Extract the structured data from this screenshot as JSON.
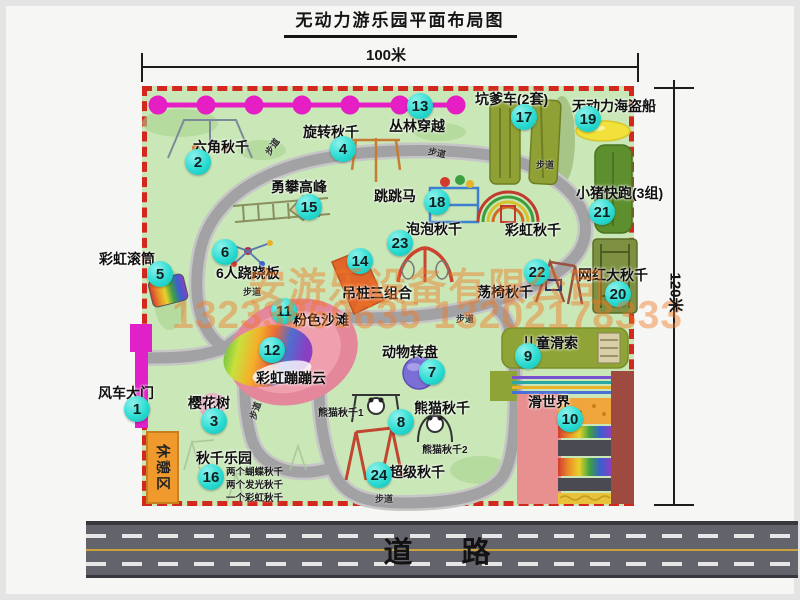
{
  "title": "无动力游乐园平面布局图",
  "dim_width": "100米",
  "dim_height": "120米",
  "road_label": "道　路",
  "path_label": "步道",
  "rest_area_label": "休憩区",
  "rainbow_swing_label": "彩虹秋千",
  "watermark": {
    "company": "安游乐设备有限公司",
    "phone": "13233860635 13202178333"
  },
  "notes": {
    "panda_1": "熊猫秋千1",
    "panda_2": "熊猫秋千2",
    "swing_park": [
      "两个蝴蝶秋千",
      "两个发光秋千",
      "一个彩虹秋千"
    ]
  },
  "colors": {
    "park_green": "#c9e7b7",
    "border_red": "#d3281e",
    "number_badge": "#2bdcd2",
    "zipline_magenta": "#e51fc4",
    "road_gray": "#63636b",
    "watermark_orange": "#f07823",
    "rest_area_orange": "#f09a2e"
  },
  "attractions": [
    {
      "num": "1",
      "name": "风车大门"
    },
    {
      "num": "2",
      "name": "六角秋千"
    },
    {
      "num": "3",
      "name": "樱花树"
    },
    {
      "num": "4",
      "name": "旋转秋千"
    },
    {
      "num": "5",
      "name": "彩虹滚筒"
    },
    {
      "num": "6",
      "name": "6人跷跷板"
    },
    {
      "num": "7",
      "name": "动物转盘"
    },
    {
      "num": "8",
      "name": "熊猫秋千"
    },
    {
      "num": "9",
      "name": "儿童滑索"
    },
    {
      "num": "10",
      "name": "滑世界"
    },
    {
      "num": "11",
      "name": "粉色沙滩"
    },
    {
      "num": "12",
      "name": "彩虹蹦蹦云"
    },
    {
      "num": "13",
      "name": "丛林穿越"
    },
    {
      "num": "14",
      "name": "吊桩三组合"
    },
    {
      "num": "15",
      "name": "勇攀高峰"
    },
    {
      "num": "16",
      "name": "秋千乐园"
    },
    {
      "num": "17",
      "name": "坑爹车(2套)"
    },
    {
      "num": "18",
      "name": "跳跳马"
    },
    {
      "num": "19",
      "name": "无动力海盗船"
    },
    {
      "num": "20",
      "name": "网红大秋千"
    },
    {
      "num": "21",
      "name": "小猪快跑(3组)"
    },
    {
      "num": "22",
      "name": "荡椅秋千"
    },
    {
      "num": "23",
      "name": "泡泡秋千"
    },
    {
      "num": "24",
      "name": "超级秋千"
    }
  ]
}
